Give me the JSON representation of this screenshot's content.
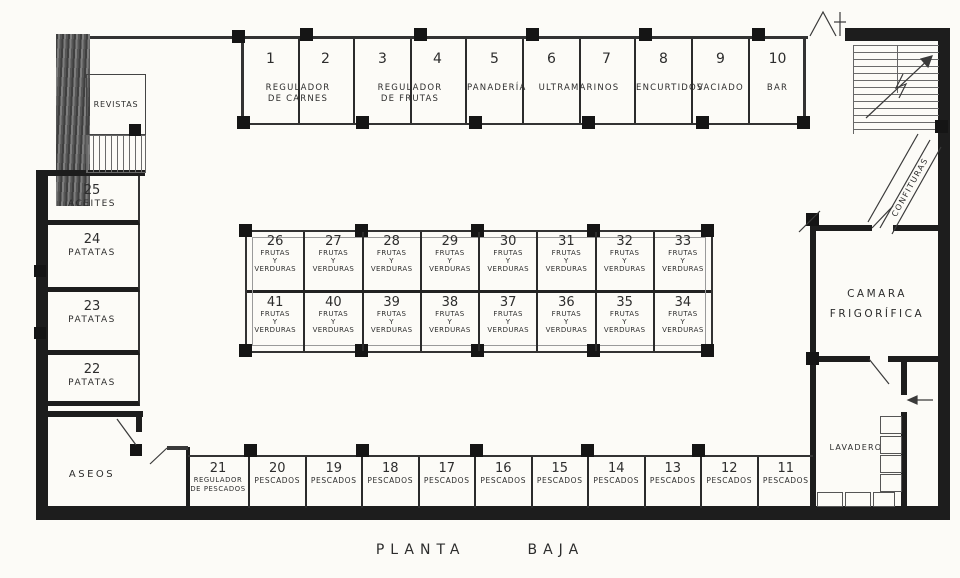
{
  "caption": {
    "word1": "PLANTA",
    "word2": "BAJA"
  },
  "colors": {
    "paper": "#fcfbf7",
    "ink": "#2d2d2d",
    "wall": "#1d1d1d",
    "line": "#3a3a3a"
  },
  "top_band": {
    "groups": [
      {
        "units": "2",
        "num1": "1",
        "num2": "2",
        "line1": "REGULADOR",
        "line2": "DE CARNES"
      },
      {
        "units": "2",
        "num1": "3",
        "num2": "4",
        "line1": "REGULADOR",
        "line2": "DE FRUTAS"
      },
      {
        "units": "1",
        "num1": "5",
        "num2": "",
        "line1": "PANADERÍA",
        "line2": ""
      },
      {
        "units": "2",
        "num1": "6",
        "num2": "7",
        "line1": "ULTRAMARINOS",
        "line2": ""
      },
      {
        "units": "1",
        "num1": "8",
        "num2": "",
        "line1": "ENCURTIDOS",
        "line2": ""
      },
      {
        "units": "1",
        "num1": "9",
        "num2": "",
        "line1": "VACIADO",
        "line2": ""
      },
      {
        "units": "1",
        "num1": "10",
        "num2": "",
        "line1": "BAR",
        "line2": ""
      }
    ]
  },
  "island": {
    "row1": [
      {
        "num": "26",
        "line1": "FRUTAS",
        "line2": "Y",
        "line3": "VERDURAS"
      },
      {
        "num": "27",
        "line1": "FRUTAS",
        "line2": "Y",
        "line3": "VERDURAS"
      },
      {
        "num": "28",
        "line1": "FRUTAS",
        "line2": "Y",
        "line3": "VERDURAS"
      },
      {
        "num": "29",
        "line1": "FRUTAS",
        "line2": "Y",
        "line3": "VERDURAS"
      },
      {
        "num": "30",
        "line1": "FRUTAS",
        "line2": "Y",
        "line3": "VERDURAS"
      },
      {
        "num": "31",
        "line1": "FRUTAS",
        "line2": "Y",
        "line3": "VERDURAS"
      },
      {
        "num": "32",
        "line1": "FRUTAS",
        "line2": "Y",
        "line3": "VERDURAS"
      },
      {
        "num": "33",
        "line1": "FRUTAS",
        "line2": "Y",
        "line3": "VERDURAS"
      }
    ],
    "row2": [
      {
        "num": "41",
        "line1": "FRUTAS",
        "line2": "Y",
        "line3": "VERDURAS"
      },
      {
        "num": "40",
        "line1": "FRUTAS",
        "line2": "Y",
        "line3": "VERDURAS"
      },
      {
        "num": "39",
        "line1": "FRUTAS",
        "line2": "Y",
        "line3": "VERDURAS"
      },
      {
        "num": "38",
        "line1": "FRUTAS",
        "line2": "Y",
        "line3": "VERDURAS"
      },
      {
        "num": "37",
        "line1": "FRUTAS",
        "line2": "Y",
        "line3": "VERDURAS"
      },
      {
        "num": "36",
        "line1": "FRUTAS",
        "line2": "Y",
        "line3": "VERDURAS"
      },
      {
        "num": "35",
        "line1": "FRUTAS",
        "line2": "Y",
        "line3": "VERDURAS"
      },
      {
        "num": "34",
        "line1": "FRUTAS",
        "line2": "Y",
        "line3": "VERDURAS"
      }
    ]
  },
  "bottom_band": {
    "stall21": {
      "num": "21",
      "line1": "REGULADOR",
      "line2": "DE PESCADOS"
    },
    "stalls": [
      {
        "num": "20",
        "label": "PESCADOS"
      },
      {
        "num": "19",
        "label": "PESCADOS"
      },
      {
        "num": "18",
        "label": "PESCADOS"
      },
      {
        "num": "17",
        "label": "PESCADOS"
      },
      {
        "num": "16",
        "label": "PESCADOS"
      },
      {
        "num": "15",
        "label": "PESCADOS"
      },
      {
        "num": "14",
        "label": "PESCADOS"
      },
      {
        "num": "13",
        "label": "PESCADOS"
      },
      {
        "num": "12",
        "label": "PESCADOS"
      },
      {
        "num": "11",
        "label": "PESCADOS"
      }
    ]
  },
  "left_wing": {
    "revistas": "REVISTAS",
    "rooms": [
      {
        "num": "25",
        "label": "ACEITES"
      },
      {
        "num": "24",
        "label": "PATATAS"
      },
      {
        "num": "23",
        "label": "PATATAS"
      },
      {
        "num": "22",
        "label": "PATATAS"
      }
    ],
    "aseos": "ASEOS"
  },
  "right_wing": {
    "confituras": "CONFITURAS",
    "camara_line1": "CAMARA",
    "camara_line2": "FRIGORÍFICA",
    "lavaderos": "LAVADEROS"
  }
}
